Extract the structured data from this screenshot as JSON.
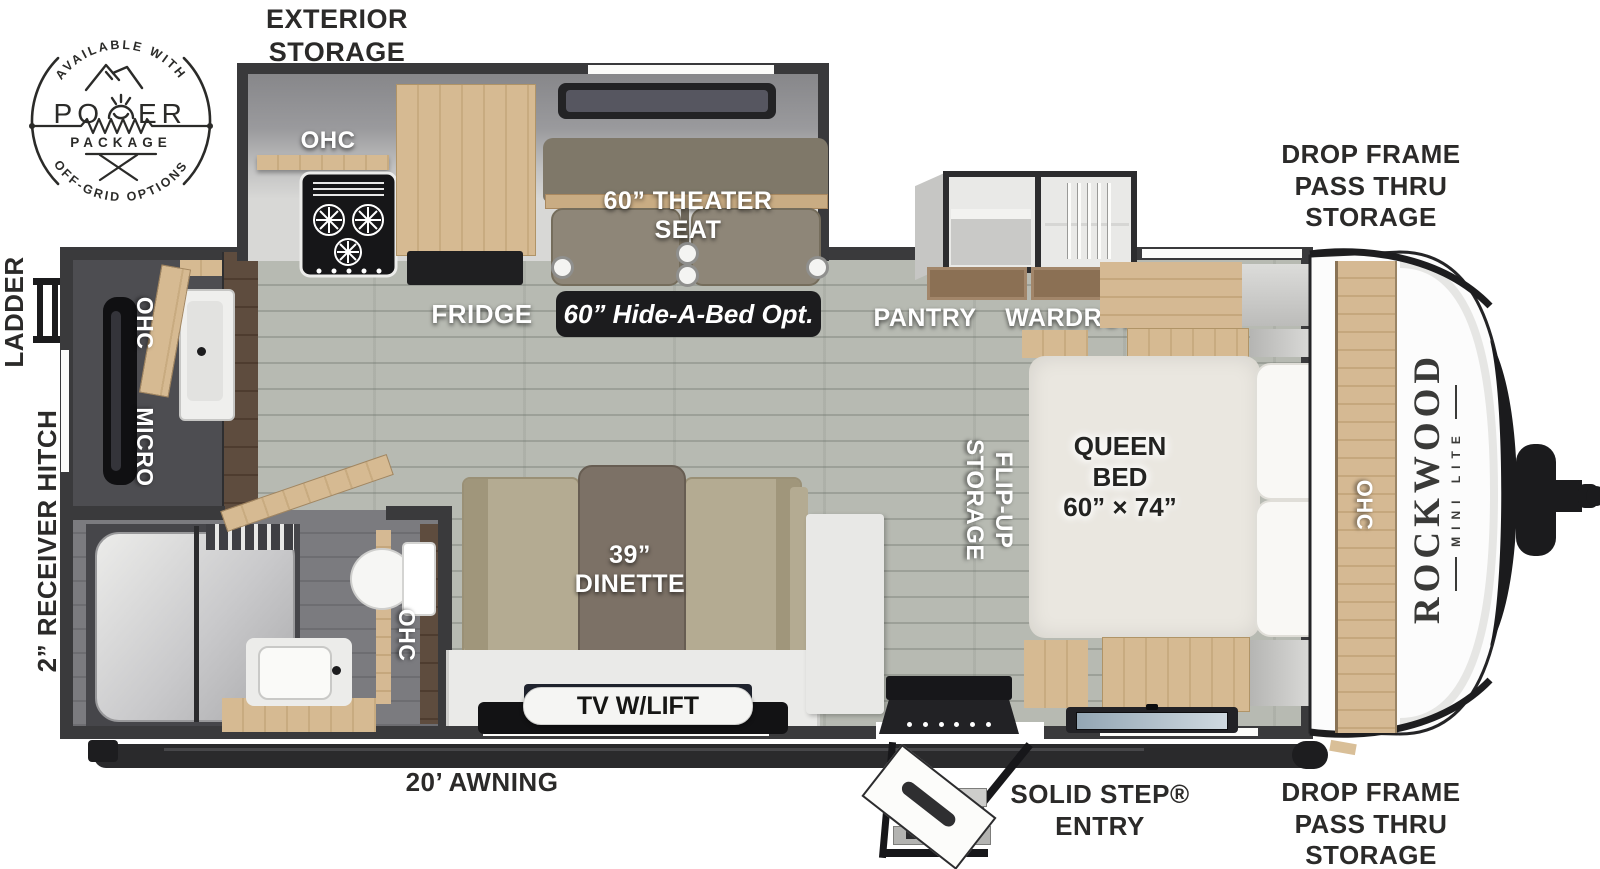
{
  "badge": {
    "arc_top": "AVAILABLE WITH",
    "power_left": "PO",
    "power_right": "ER",
    "package": "PACKAGE",
    "arc_bottom": "OFF-GRID OPTIONS"
  },
  "exterior": {
    "storage_top": "EXTERIOR\nSTORAGE",
    "ladder": "LADDER",
    "hitch": "2” RECEIVER HITCH",
    "drop_frame_front_top": "DROP FRAME\nPASS THRU\nSTORAGE",
    "drop_frame_front_bottom": "DROP FRAME\nPASS THRU\nSTORAGE",
    "awning": "20’ AWNING",
    "step_entry": "SOLID STEP®\nENTRY"
  },
  "interior": {
    "slide_ohc": "OHC",
    "theater_seat": "60” THEATER\nSEAT",
    "fridge": "FRIDGE",
    "hide_a_bed": "60” Hide-A-Bed Opt.",
    "pantry": "PANTRY",
    "wardrobe": "WARDROBE",
    "flip_up": "FLIP-UP\nSTORAGE",
    "queen_bed": "QUEEN\nBED\n60” × 74”",
    "bed_ohc": "OHC",
    "galley_ohc": "OHC",
    "micro": "MICRO",
    "bath_ohc": "OHC",
    "dinette": "39”\nDINETTE",
    "tv": "TV W/LIFT"
  },
  "cap": {
    "brand": "ROCKWOOD",
    "model": "MINI LITE"
  },
  "colors": {
    "wall": "#3a3a3c",
    "floor": "#b7bab2",
    "light_wood": "#d6ba92",
    "dark_wood": "#5e4c3e",
    "fabric": "#b4ab92",
    "theater_fabric": "#8e8678",
    "label_dark": "#2b2a29",
    "badge_ink": "#2b2b29",
    "mattress": "#eae7e0",
    "callout_bg": "#1c1c1e"
  }
}
